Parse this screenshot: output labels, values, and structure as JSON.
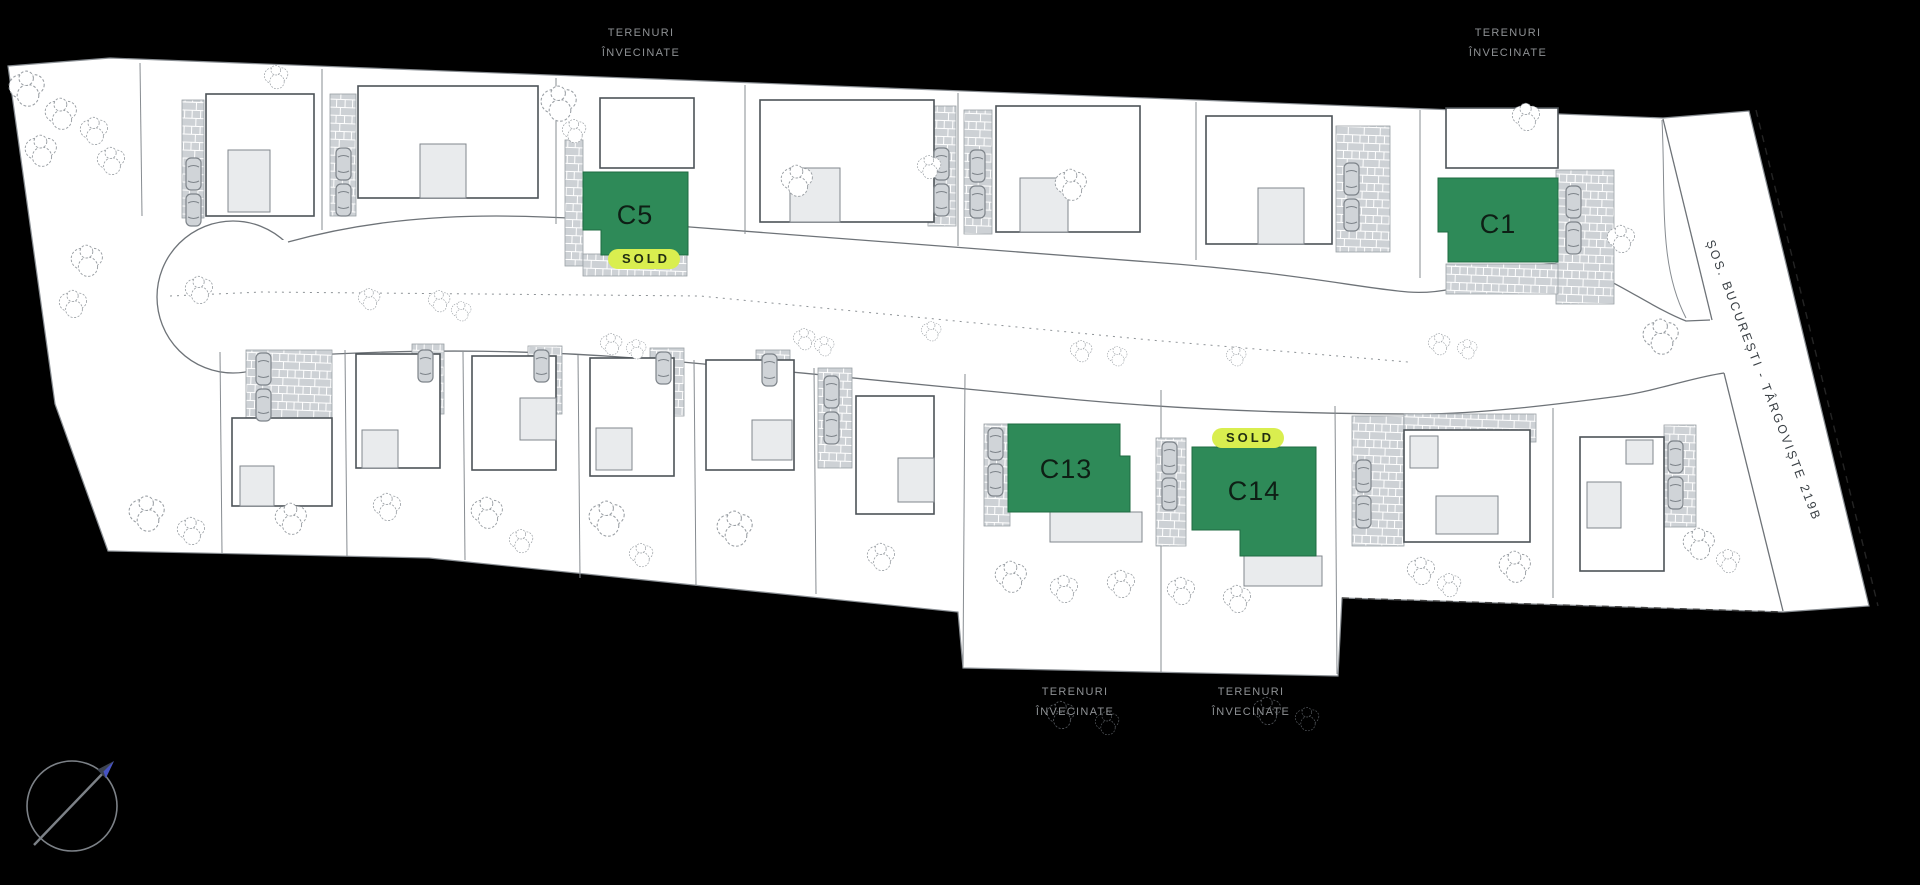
{
  "canvas": {
    "width": 1920,
    "height": 885,
    "background": "#000000"
  },
  "street": {
    "name": "ȘOS. BUCUREȘTI - TÂRGOVIȘTE 219B"
  },
  "legend": {
    "sold_label": "SOLD"
  },
  "houses": {
    "c5": {
      "label": "C5",
      "sold": true
    },
    "c1": {
      "label": "C1",
      "sold": false
    },
    "c13": {
      "label": "C13",
      "sold": false
    },
    "c14": {
      "label": "C14",
      "sold": true
    }
  },
  "edge_labels": [
    {
      "position": "top-center",
      "line1": "TERENURI",
      "line2": "ÎNVECINATE"
    },
    {
      "position": "top-right",
      "line1": "TERENURI",
      "line2": "ÎNVECINATE"
    },
    {
      "position": "bottom-center",
      "line1": "TERENURI",
      "line2": "ÎNVECINATE"
    },
    {
      "position": "bottom-right",
      "line1": "TERENURI",
      "line2": "ÎNVECINATE"
    }
  ],
  "compass": {
    "direction": "NE"
  },
  "colors": {
    "background": "#000000",
    "plan_fill": "#ffffff",
    "house_green": "#2e8a58",
    "badge_bg": "#d9ee4f",
    "badge_text": "#222f12",
    "label_text": "#0e1f15",
    "paving": "#cdd1d5",
    "subrect": "#e9ebed",
    "tree_stroke": "#9ba0a5",
    "edge_label_text": "#8e9194",
    "street_text": "#3a4045",
    "road_line": "#6e7378"
  }
}
